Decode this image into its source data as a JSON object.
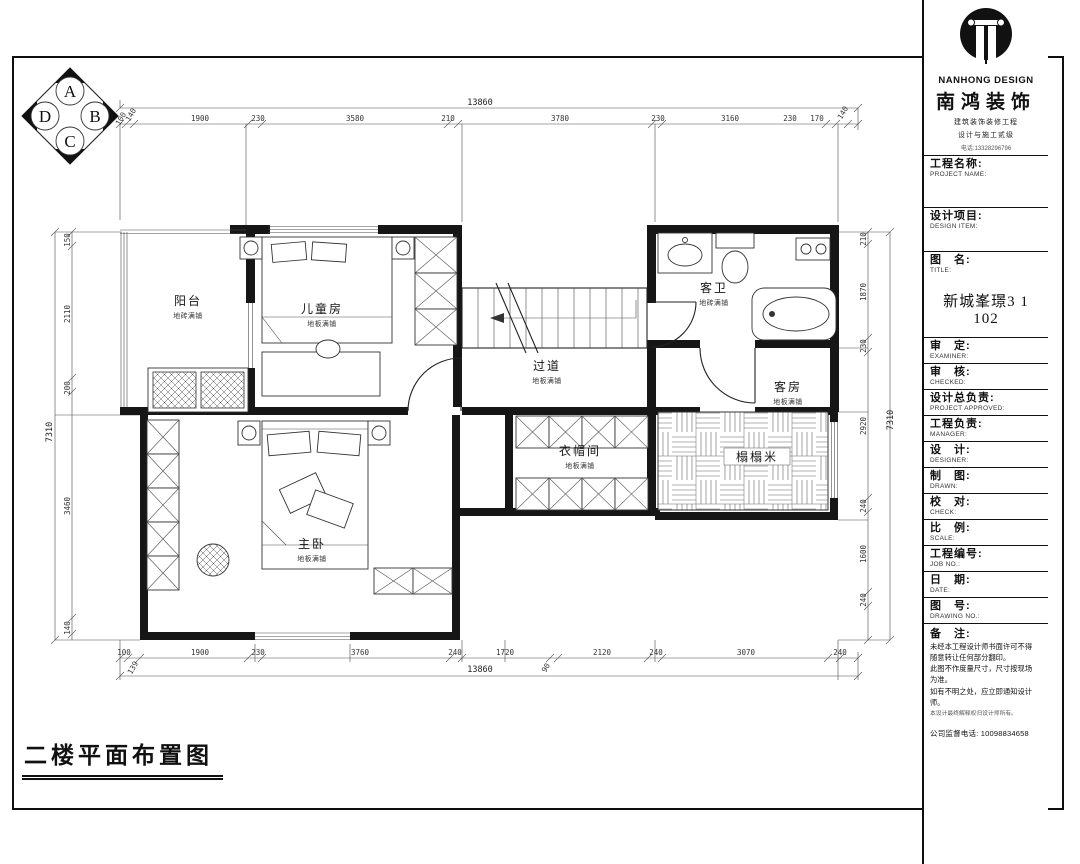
{
  "footer": {
    "title": "二楼平面布置图"
  },
  "compass": {
    "a": "A",
    "b": "B",
    "c": "C",
    "d": "D"
  },
  "rooms": [
    {
      "name": "阳台",
      "finish": "地砖满铺"
    },
    {
      "name": "儿童房",
      "finish": "地板满铺"
    },
    {
      "name": "过道",
      "finish": "地板满铺"
    },
    {
      "name": "客卫",
      "finish": "地砖满铺"
    },
    {
      "name": "客房",
      "finish": "地板满铺"
    },
    {
      "name": "衣帽间",
      "finish": "地板满铺"
    },
    {
      "name": "榻榻米",
      "finish": ""
    },
    {
      "name": "主卧",
      "finish": "地板满铺"
    }
  ],
  "dims": {
    "top": {
      "overall": "13860",
      "segments": [
        "100",
        "140",
        "1900",
        "230",
        "3580",
        "210",
        "3780",
        "230",
        "3160",
        "230",
        "170",
        "140"
      ]
    },
    "bottom": {
      "overall": "13860",
      "segments": [
        "100",
        "139",
        "1900",
        "230",
        "3760",
        "240",
        "1720",
        "90",
        "2120",
        "240",
        "3070",
        "240"
      ]
    },
    "left": {
      "overall": "7310",
      "segments": [
        "150",
        "2110",
        "200",
        "3460",
        "140"
      ]
    },
    "right": {
      "overall": "7310",
      "segments": [
        "210",
        "1870",
        "230",
        "2920",
        "240",
        "1600",
        "240"
      ]
    }
  },
  "title_block": {
    "logo": {
      "brand_en": "NANHONG DESIGN",
      "brand_cn": "南鸿装饰",
      "line1": "建筑装饰装修工程",
      "line2": "设计与施工贰级",
      "line3": "电话:13328296796"
    },
    "rows": [
      {
        "cn": "工程名称:",
        "en": "PROJECT NAME:"
      },
      {
        "cn": "设计项目:",
        "en": "DESIGN ITEM:"
      },
      {
        "cn": "图　名:",
        "en": "TITLE:",
        "value": "新城峯璟3 1 102"
      },
      {
        "cn": "审　定:",
        "en": "EXAMINER:"
      },
      {
        "cn": "审　核:",
        "en": "CHECKED:"
      },
      {
        "cn": "设计总负责:",
        "en": "PROJECT APPROVED:"
      },
      {
        "cn": "工程负责:",
        "en": "MANAGER:"
      },
      {
        "cn": "设　计:",
        "en": "DESIGNER:"
      },
      {
        "cn": "制　图:",
        "en": "DRAWN:"
      },
      {
        "cn": "校　对:",
        "en": "CHECK:"
      },
      {
        "cn": "比　例:",
        "en": "SCALE:"
      },
      {
        "cn": "工程编号:",
        "en": "JOB NO.:"
      },
      {
        "cn": "日　期:",
        "en": "DATE:"
      },
      {
        "cn": "图　号:",
        "en": "DRAWING NO.:"
      }
    ],
    "notes": {
      "label": "备　注:",
      "lines": [
        "未经本工程设计师书面许可不得",
        "随意转让任何部分翻印。",
        "此图不作度量尺寸，尺寸按现场",
        "为准。",
        "如有不明之处，应立即通知设计",
        "师。",
        "本设计最终解释权归设计师所有。"
      ],
      "phone": "公司监督电话: 10098834658"
    }
  }
}
